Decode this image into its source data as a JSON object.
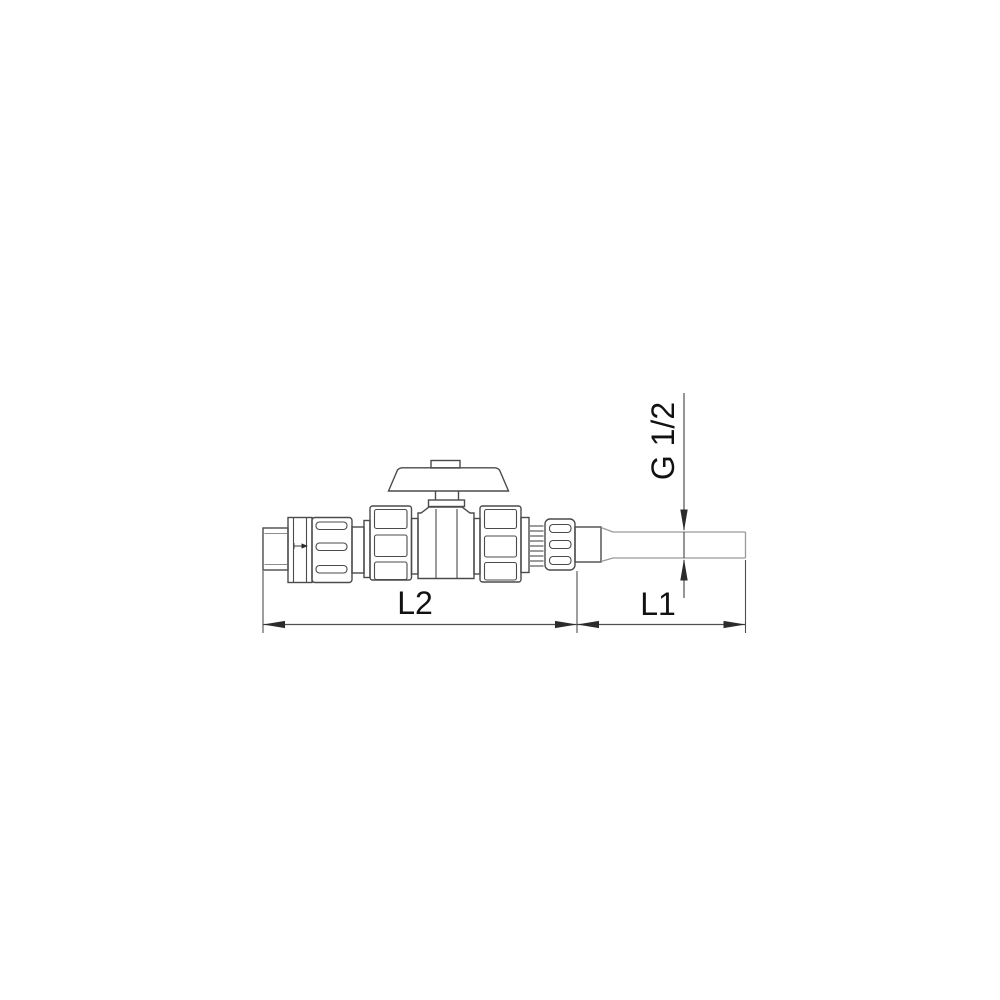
{
  "drawing": {
    "type": "technical-dimension-diagram",
    "subject": "ball valve assembly with check valve, union nuts, knurled coupling nut and connection pipe",
    "labels": {
      "length_total": "L2",
      "length_pipe": "L1",
      "thread_size": "G 1/2"
    },
    "dimensions": [
      {
        "name": "L2",
        "measures": "valve assembly length",
        "orientation": "horizontal"
      },
      {
        "name": "L1",
        "measures": "connection pipe length",
        "orientation": "horizontal"
      },
      {
        "name": "G 1/2",
        "measures": "pipe thread diameter",
        "orientation": "vertical"
      }
    ],
    "colors": {
      "background": "#ffffff",
      "outline": "#4b4b4b",
      "pipe_outline": "#9a9a9a",
      "dimension_line": "#4f4f4f",
      "arrow": "#2b2b2b",
      "text": "#111111"
    }
  }
}
